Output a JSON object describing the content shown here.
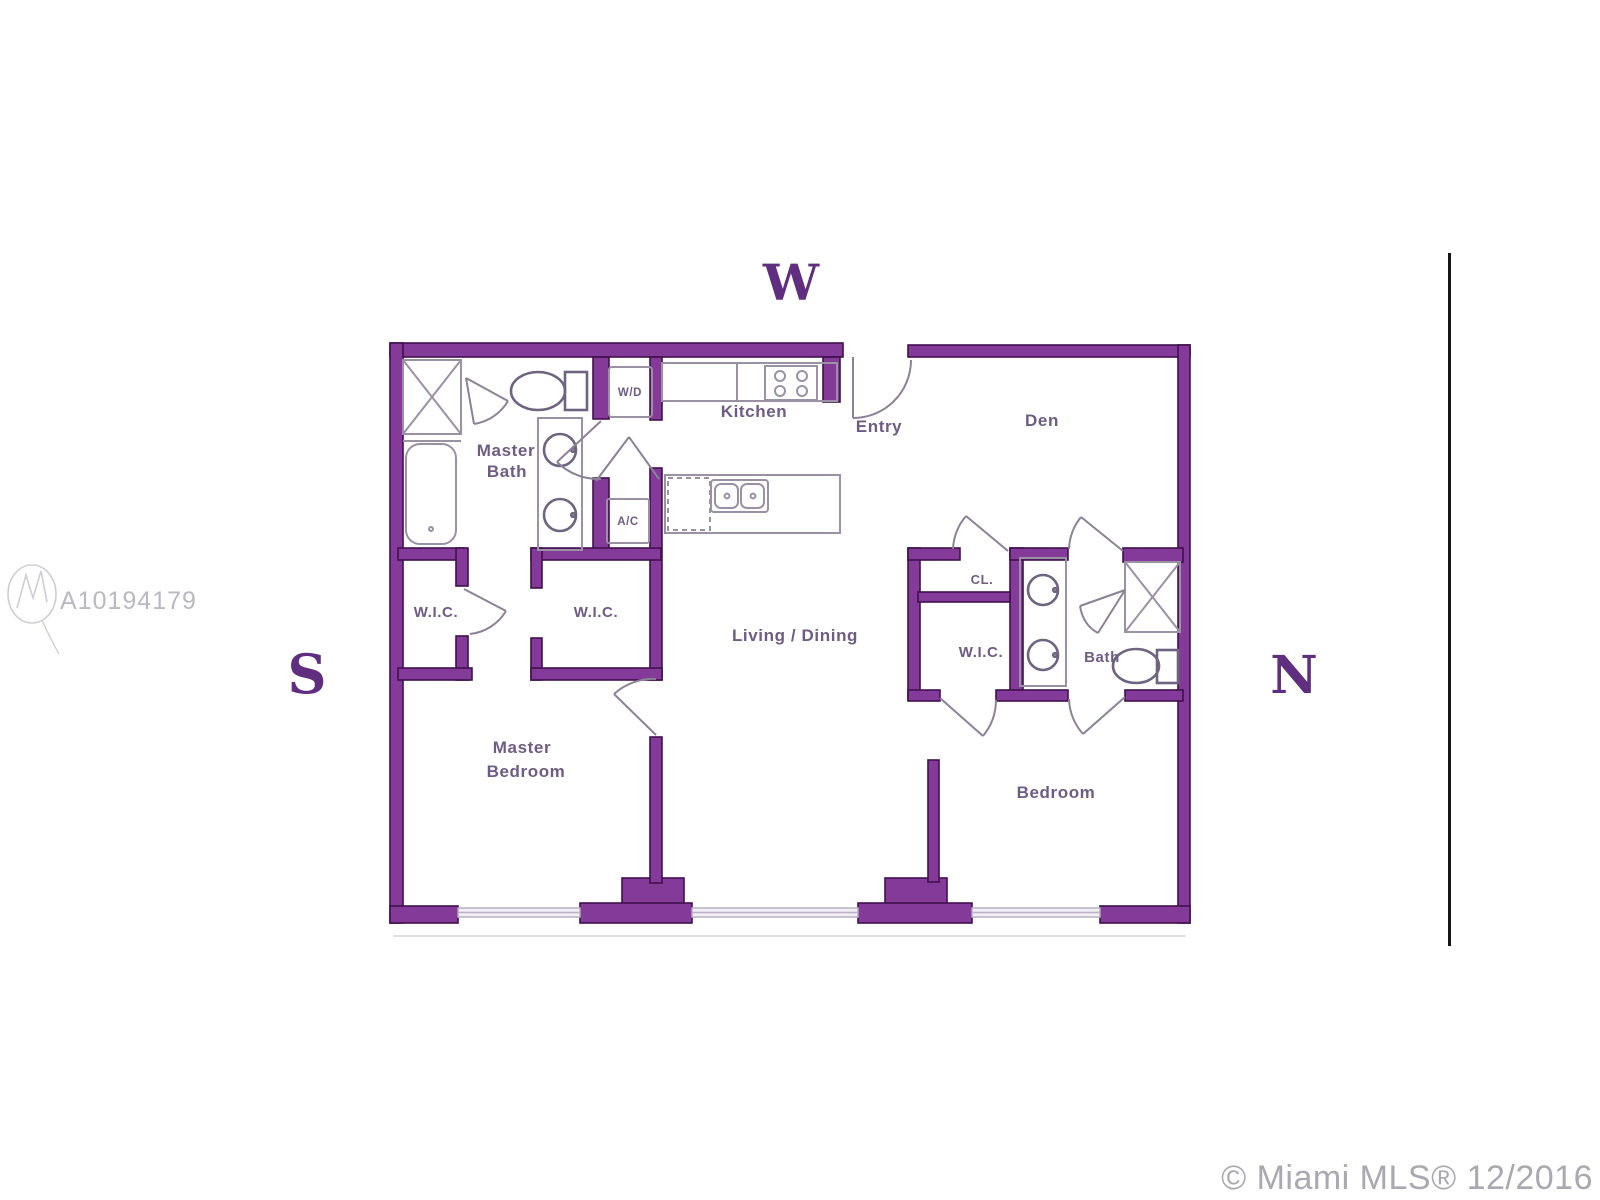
{
  "compass": {
    "west": "W",
    "south": "S",
    "north": "N"
  },
  "rooms": {
    "master_bath_line1": "Master",
    "master_bath_line2": "Bath",
    "wd": "W/D",
    "ac": "A/C",
    "kitchen": "Kitchen",
    "entry": "Entry",
    "den": "Den",
    "wic_left": "W.I.C.",
    "wic_middle": "W.I.C.",
    "wic_right": "W.I.C.",
    "living_dining": "Living / Dining",
    "closet": "CL.",
    "bath": "Bath",
    "master_bedroom_line1": "Master",
    "master_bedroom_line2": "Bedroom",
    "bedroom": "Bedroom"
  },
  "watermark": {
    "id": "A10194179"
  },
  "footer": {
    "copyright": "© Miami MLS® 12/2016"
  },
  "colors": {
    "wall": "#833a99",
    "wall_outline": "#42104e",
    "fixture": "#9a91a5",
    "plumbing": "#6f6480",
    "door": "#8b8296",
    "window": "#b9b1c4",
    "label": "#6f5c82",
    "compass": "#5f2e7e",
    "watermark": "#b9b9c1",
    "copyright": "#a9a9b1",
    "divider": "#161616"
  }
}
